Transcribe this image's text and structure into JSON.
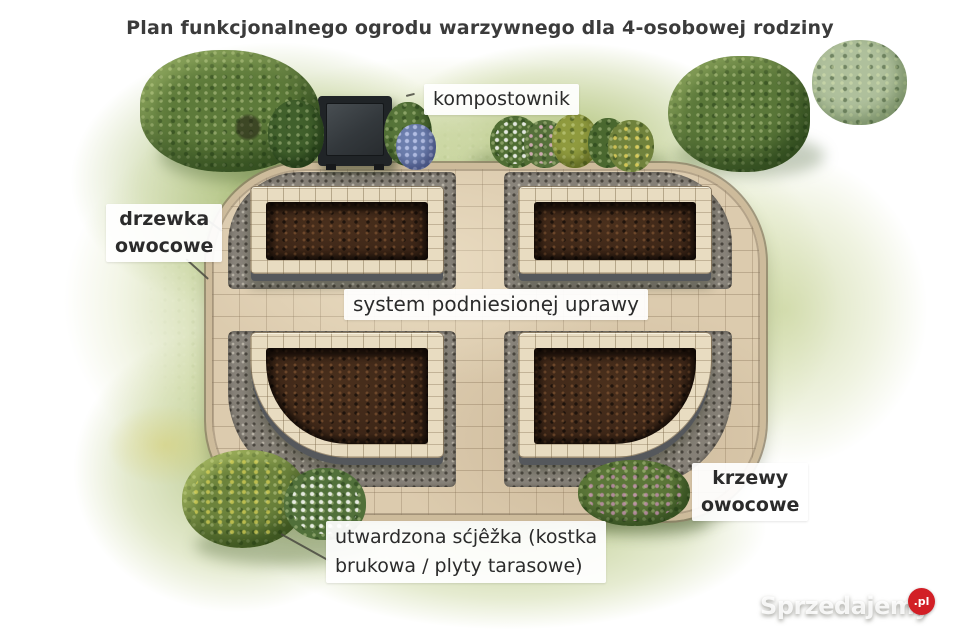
{
  "title": "Plan funkcjonalnego ogrodu warzywnego dla 4-osobowej rodziny",
  "labels": {
    "compost": "kompostownik",
    "fruit_trees_line1": "drzewka",
    "fruit_trees_line2": "owocowe",
    "raised_bed_system": "system podniesionęj uprawy",
    "fruit_shrubs_line1": "krzewy",
    "fruit_shrubs_line2": "owocowe",
    "hardened_path_line1": "utwardzona sćjêžka (kostka",
    "hardened_path_line2": "brukowa / plyty tarasowe)"
  },
  "watermark": {
    "brand": "Sprzedajemy",
    "tld": ".pl"
  },
  "colors": {
    "grass_green": "#b7c488",
    "paver_beige": "#dccbae",
    "gravel_gray": "#89847b",
    "soil_brown": "#3b2517",
    "stone_cream": "#e8dcc1",
    "compost_bin": "#202427",
    "brand_red": "#d21f26",
    "text_dark": "#2b2b2b"
  },
  "scene_elements": {
    "compost_bin": "compost bin (dark box, top left of terrace)",
    "raised_beds": "four raised beds with dark soil in 2x2 grid",
    "paved_terrace": "rounded paved terrace with cross-shaped path",
    "gravel_pockets": "gray gravel surrounds around each bed",
    "trees": "fruit trees top-left and top-right",
    "shrubs": "flowering shrubs along top edge, bottom-left and bottom-right"
  }
}
